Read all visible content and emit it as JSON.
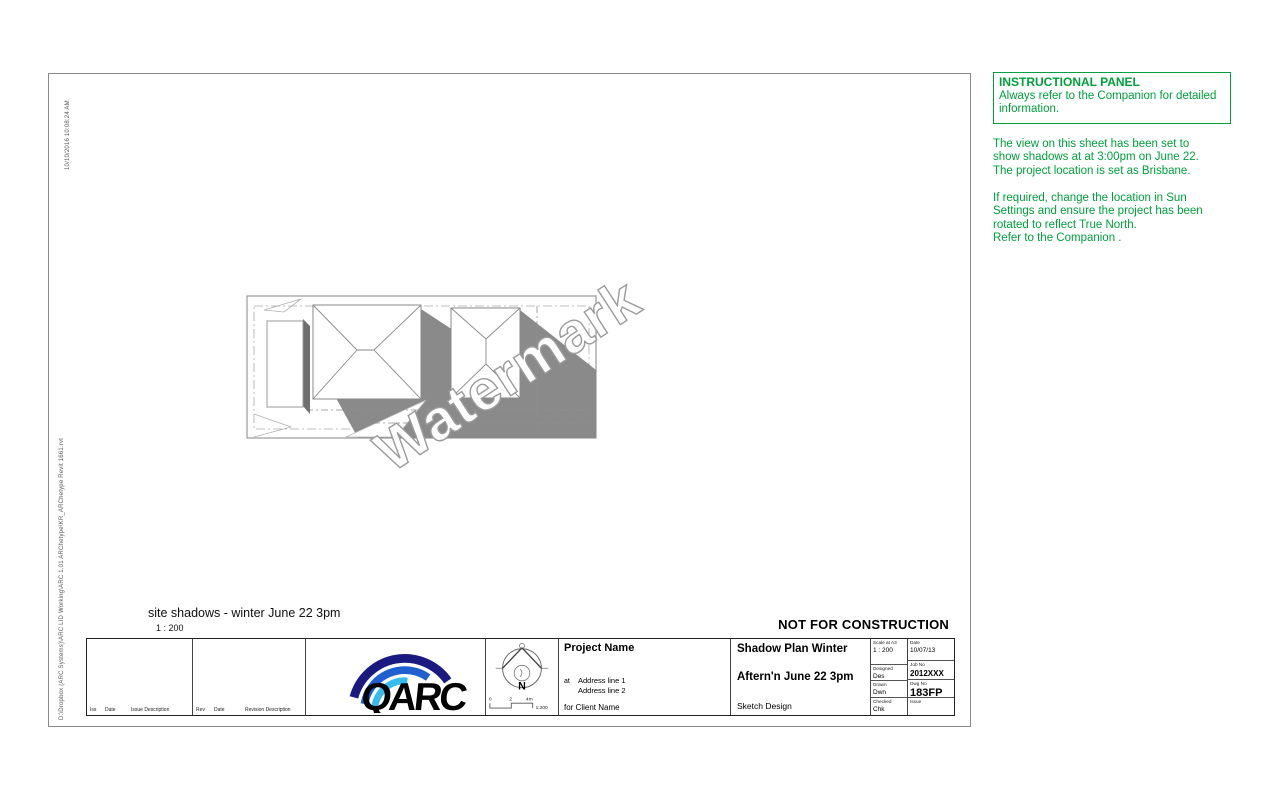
{
  "sheet": {
    "timestamp": "10/10/2016 10:08:24 AM",
    "file_path": "D:\\Dropbox (ARC Systems)\\ARC LID Working\\ARC 1.01 ARChetype\\KR_ARChetype Revit 1661.rvt",
    "stamp": "NOT FOR CONSTRUCTION"
  },
  "viewport": {
    "label": "site shadows - winter June 22 3pm",
    "scale": "1 : 200",
    "watermark": "Watermark"
  },
  "instructional_panel": {
    "title": "INSTRUCTIONAL PANEL",
    "intro": "Always refer to the Companion for detailed\ninformation.",
    "paragraph1": "The view on this sheet has been set to\nshow shadows at at 3:00pm on June 22.\nThe project location is set as Brisbane.",
    "paragraph2": "If required, change the location in Sun\nSettings and ensure the project has been\nrotated to reflect True North.\nRefer to the Companion ."
  },
  "title_block": {
    "issue_table": {
      "col1": "Iss",
      "col2": "Date",
      "col3": "Issue Description"
    },
    "revision_table": {
      "col1": "Rev",
      "col2": "Date",
      "col3": "Revision Description"
    },
    "logo_text": "QARC",
    "north_label": "N",
    "scale_bar": {
      "tick0": "0",
      "tick2": "2",
      "tick4": "4m",
      "ratio": "1:200"
    },
    "project": {
      "name": "Project Name",
      "at": "at",
      "address1": "Address line 1",
      "address2": "Address line 2",
      "client": "for Client Name"
    },
    "sheet_title": {
      "line1": "Shadow Plan Winter",
      "line2": "Aftern'n June 22 3pm",
      "line3": "Sketch Design"
    },
    "meta_left": [
      {
        "label": "Scale at A3",
        "value": "1 : 200"
      },
      {
        "label": "Designed",
        "value": "Des"
      },
      {
        "label": "Drawn",
        "value": "Dwn"
      },
      {
        "label": "Checked",
        "value": "Chk"
      }
    ],
    "meta_right": [
      {
        "label": "Date",
        "value": "10/07/13"
      },
      {
        "label": "Job No",
        "value": "2012XXX"
      },
      {
        "label": "Dwg No",
        "value": "183FP"
      },
      {
        "label": "Issue",
        "value": ""
      }
    ]
  },
  "colors": {
    "accent_green": "#00a03c",
    "shadow_gray": "#8a8a8a",
    "logo_navy": "#191980",
    "logo_blue": "#1f5fd0",
    "logo_cyan": "#35bdee"
  }
}
